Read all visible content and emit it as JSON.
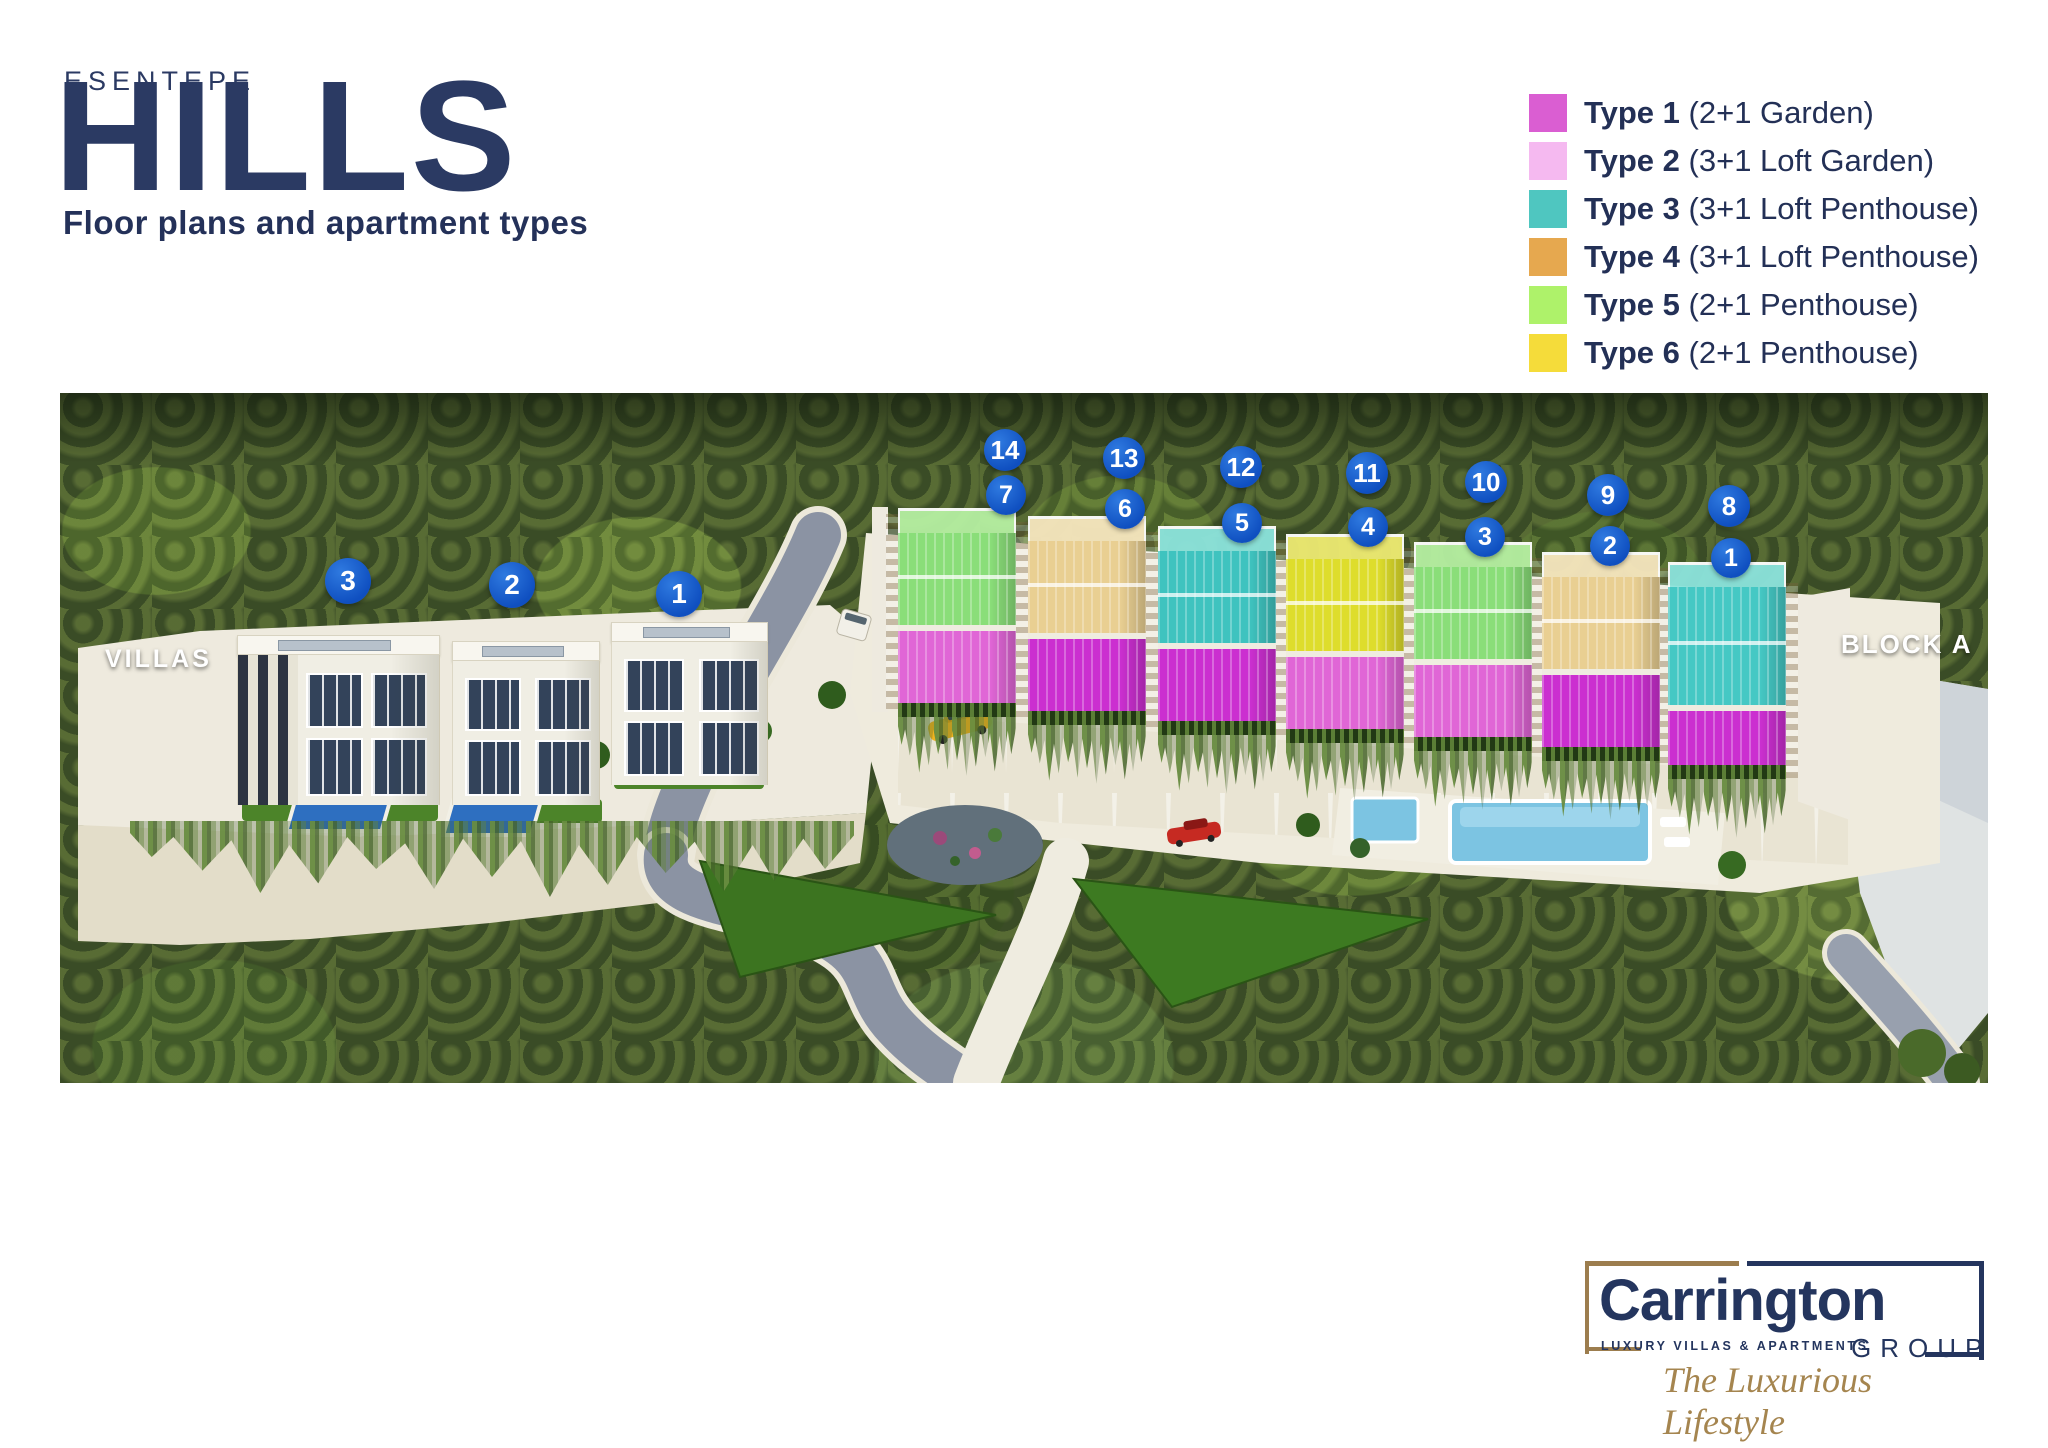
{
  "header": {
    "brand_top": "ESENTEPE",
    "brand_main": "HILLS",
    "tagline": "Floor plans and apartment types"
  },
  "legend": {
    "items": [
      {
        "label": "Type 1",
        "description": "(2+1 Garden)",
        "color": "#da5ed2"
      },
      {
        "label": "Type 2",
        "description": "(3+1 Loft Garden)",
        "color": "#f5b9f0"
      },
      {
        "label": "Type 3",
        "description": "(3+1 Loft Penthouse)",
        "color": "#4fc6c0"
      },
      {
        "label": "Type 4",
        "description": "(3+1 Loft Penthouse)",
        "color": "#e6a84f"
      },
      {
        "label": "Type 5",
        "description": "(2+1 Penthouse)",
        "color": "#aef26a"
      },
      {
        "label": "Type 6",
        "description": "(2+1 Penthouse)",
        "color": "#f5dc3a"
      }
    ]
  },
  "site_plan": {
    "villas_label": "VILLAS",
    "block_label": "BLOCK A",
    "villa_markers": [
      "3",
      "2",
      "1"
    ],
    "units": [
      {
        "top_marker": "14",
        "bottom_marker": "7",
        "top_color": "#8ade79",
        "top_light": "#b6f0a2",
        "bottom_color": "#e066d6"
      },
      {
        "top_marker": "13",
        "bottom_marker": "6",
        "top_color": "#e9cf92",
        "top_light": "#f7e7bf",
        "bottom_color": "#cb2fd0"
      },
      {
        "top_marker": "12",
        "bottom_marker": "5",
        "top_color": "#3fc3bf",
        "top_light": "#8ce4dd",
        "bottom_color": "#cb2fd0"
      },
      {
        "top_marker": "11",
        "bottom_marker": "4",
        "top_color": "#dedd2b",
        "top_light": "#eeeb72",
        "bottom_color": "#e066d6"
      },
      {
        "top_marker": "10",
        "bottom_marker": "3",
        "top_color": "#8ade79",
        "top_light": "#b6f0a2",
        "bottom_color": "#e066d6"
      },
      {
        "top_marker": "9",
        "bottom_marker": "2",
        "top_color": "#e9cf92",
        "top_light": "#f7e7bf",
        "bottom_color": "#cb2fd0"
      },
      {
        "top_marker": "8",
        "bottom_marker": "1",
        "top_color": "#45c8c4",
        "top_light": "#8ce4dd",
        "bottom_color": "#cb2fd0"
      }
    ]
  },
  "footer_logo": {
    "brand": "Carrington",
    "subtitle": "LUXURY VILLAS & APARTMENTS",
    "group_label": "GROUP",
    "tagline": "The Luxurious Lifestyle"
  }
}
